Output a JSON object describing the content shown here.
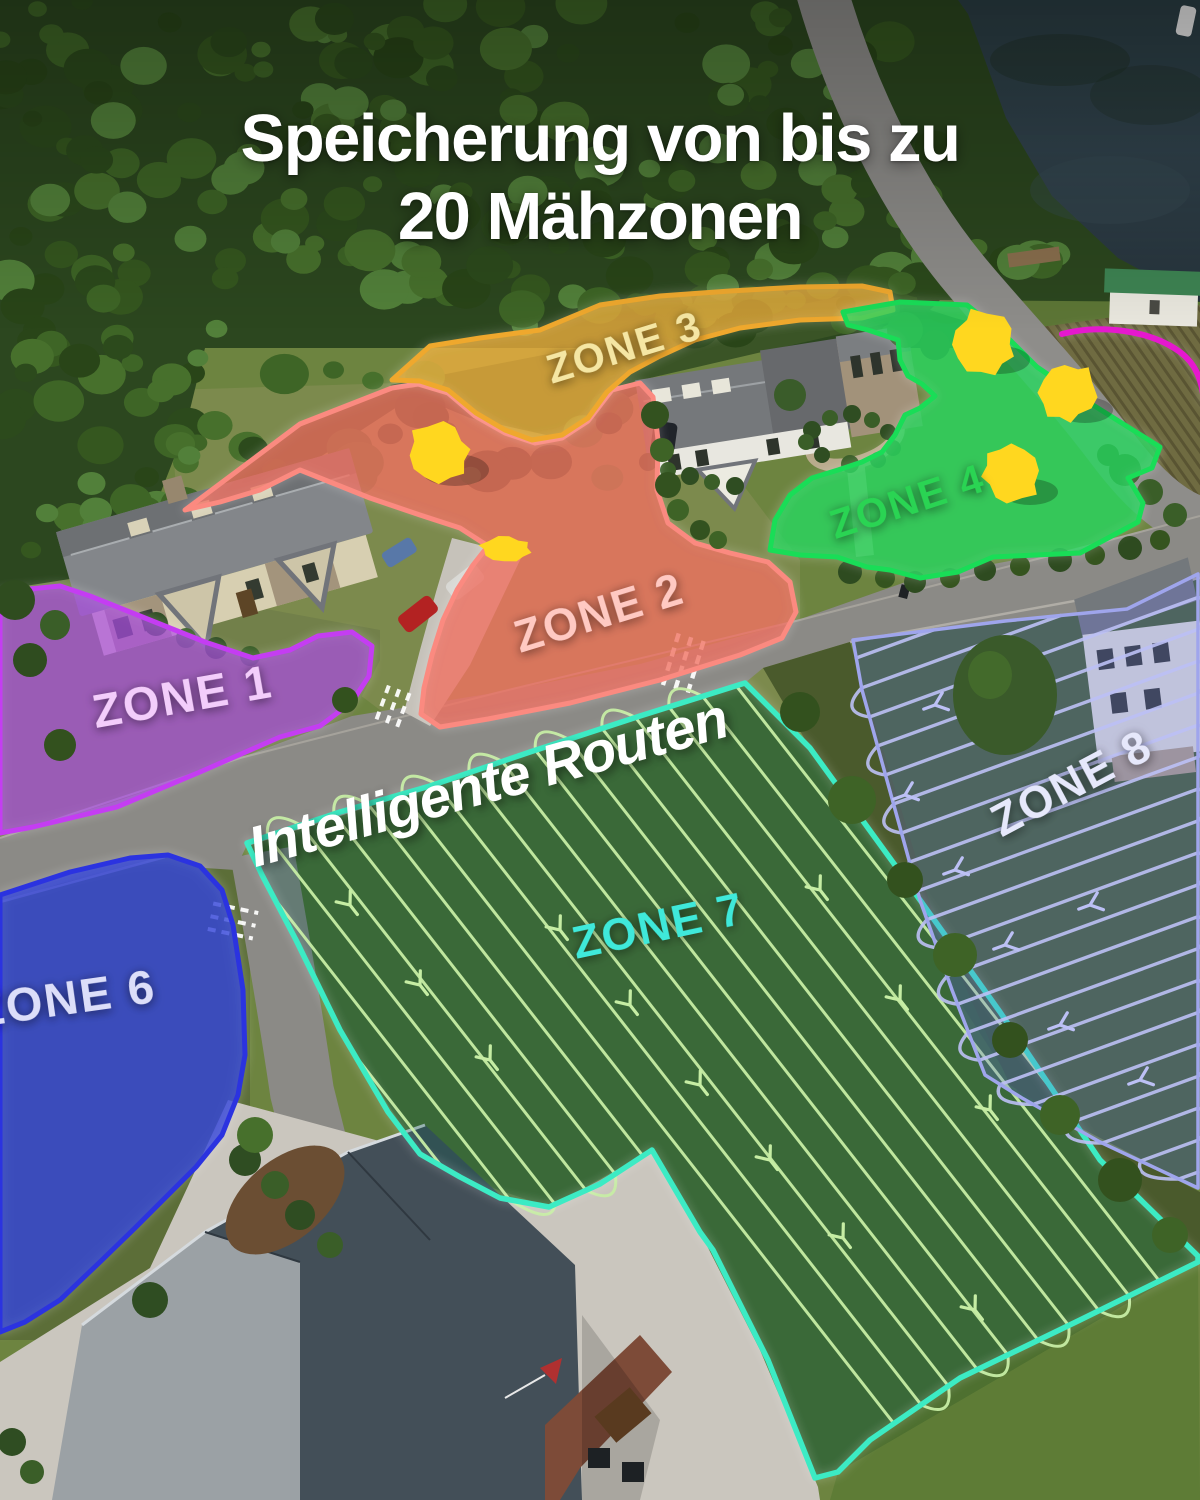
{
  "title": {
    "line1": "Speicherung von bis zu",
    "line2": "20 Mähzonen"
  },
  "map_overlay": {
    "routes_caption": "Intelligente Routen",
    "zones": {
      "z1": {
        "label": "ZONE 1",
        "outline_color": "#c43df2",
        "label_color": "#f3cdfb"
      },
      "z2": {
        "label": "ZONE 2",
        "outline_color": "#fb8a80",
        "label_color": "#ffc9c2"
      },
      "z3": {
        "label": "ZONE 3",
        "outline_color": "#efa82d",
        "label_color": "#f5e6a3"
      },
      "z4": {
        "label": "ZONE 4",
        "outline_color": "#19dd57",
        "label_color": "#2ad453"
      },
      "z5": {
        "label": "",
        "outline_color": "#e518ce"
      },
      "z6": {
        "label": "ZONE 6",
        "outline_color": "#2b33e0",
        "label_color": "#dcdef9"
      },
      "z7": {
        "label": "ZONE 7",
        "outline_color": "#3cebc4",
        "label_color": "#3fe9da",
        "route_line_color": "#c6eda4"
      },
      "z8": {
        "label": "ZONE 8",
        "outline_color": "#9fa5ec",
        "label_color": "#e6e8fb",
        "route_line_color": "#bcc0f5"
      }
    },
    "obstacle_highlight_color": "#ffd71f"
  }
}
